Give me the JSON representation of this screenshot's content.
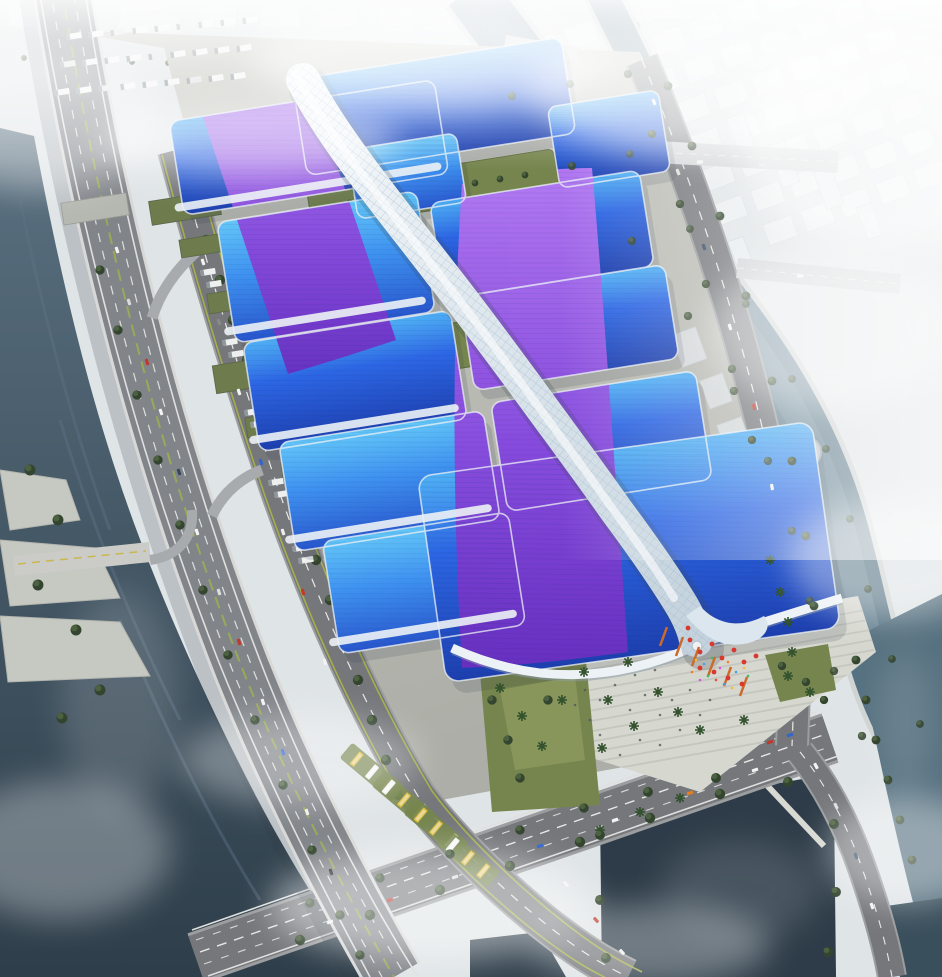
{
  "scene": {
    "type": "architectural-aerial-render",
    "subject": "exhibition-convention-center-complex",
    "view": "oblique-aerial",
    "elements": [
      "hazy-city-skyline",
      "winding-canal",
      "river",
      "elevated-expressway",
      "arterial-road",
      "exhibition-hall-roofs",
      "purple-ribbon-motif",
      "central-serpentine-corridor",
      "rooftop-gardens",
      "entrance-plaza",
      "festive-red-decorations",
      "palm-trees",
      "square-pond",
      "lake",
      "truck-parking",
      "bus-parking",
      "logistics-warehouses",
      "road-intersections"
    ]
  },
  "palette": {
    "haze-base": "#dfe4e6",
    "city-block": "#eff2f3",
    "city-shadow": "#cdd4d7",
    "pavement": "#b9bab3",
    "pavement-light": "#cbccc5",
    "plaza": "#d6d7cf",
    "step-line": "#c2c4bc",
    "road": "#75777b",
    "road-curb": "#9b9d9f",
    "lane-white": "#e8e9e7",
    "lane-yellow": "#c9b84e",
    "median-green": "#98a957",
    "highway": "#81858a",
    "water-deep": "#2e3e4a",
    "water": "#47596a",
    "canal-light": "#7e98a6",
    "canal-dark": "#4e6b7c",
    "pond": "#2d3c48",
    "tree-dark": "#33452f",
    "tree-mid": "#4c6140",
    "palm-green": "#2f4f2b",
    "lawn": "#76854e",
    "lawn-light": "#9aa86a",
    "roof-cyan-light": "#4fb0f4",
    "roof-blue": "#2d66e4",
    "roof-navy": "#1d3fae",
    "purple-light": "#b678f2",
    "purple": "#8a4add",
    "purple-deep": "#6a2fc0",
    "spine-light": "#f4f8fb",
    "spine-shade": "#c3d2dd",
    "trim-white": "#edf2f6",
    "warehouse-olive": "#6e7b4c",
    "warehouse-side": "#9aa08f",
    "decor-red": "#d8382e",
    "decor-orange": "#cc6a2a",
    "bus-yellow": "#d9ba41",
    "shadow": "#35404c"
  }
}
